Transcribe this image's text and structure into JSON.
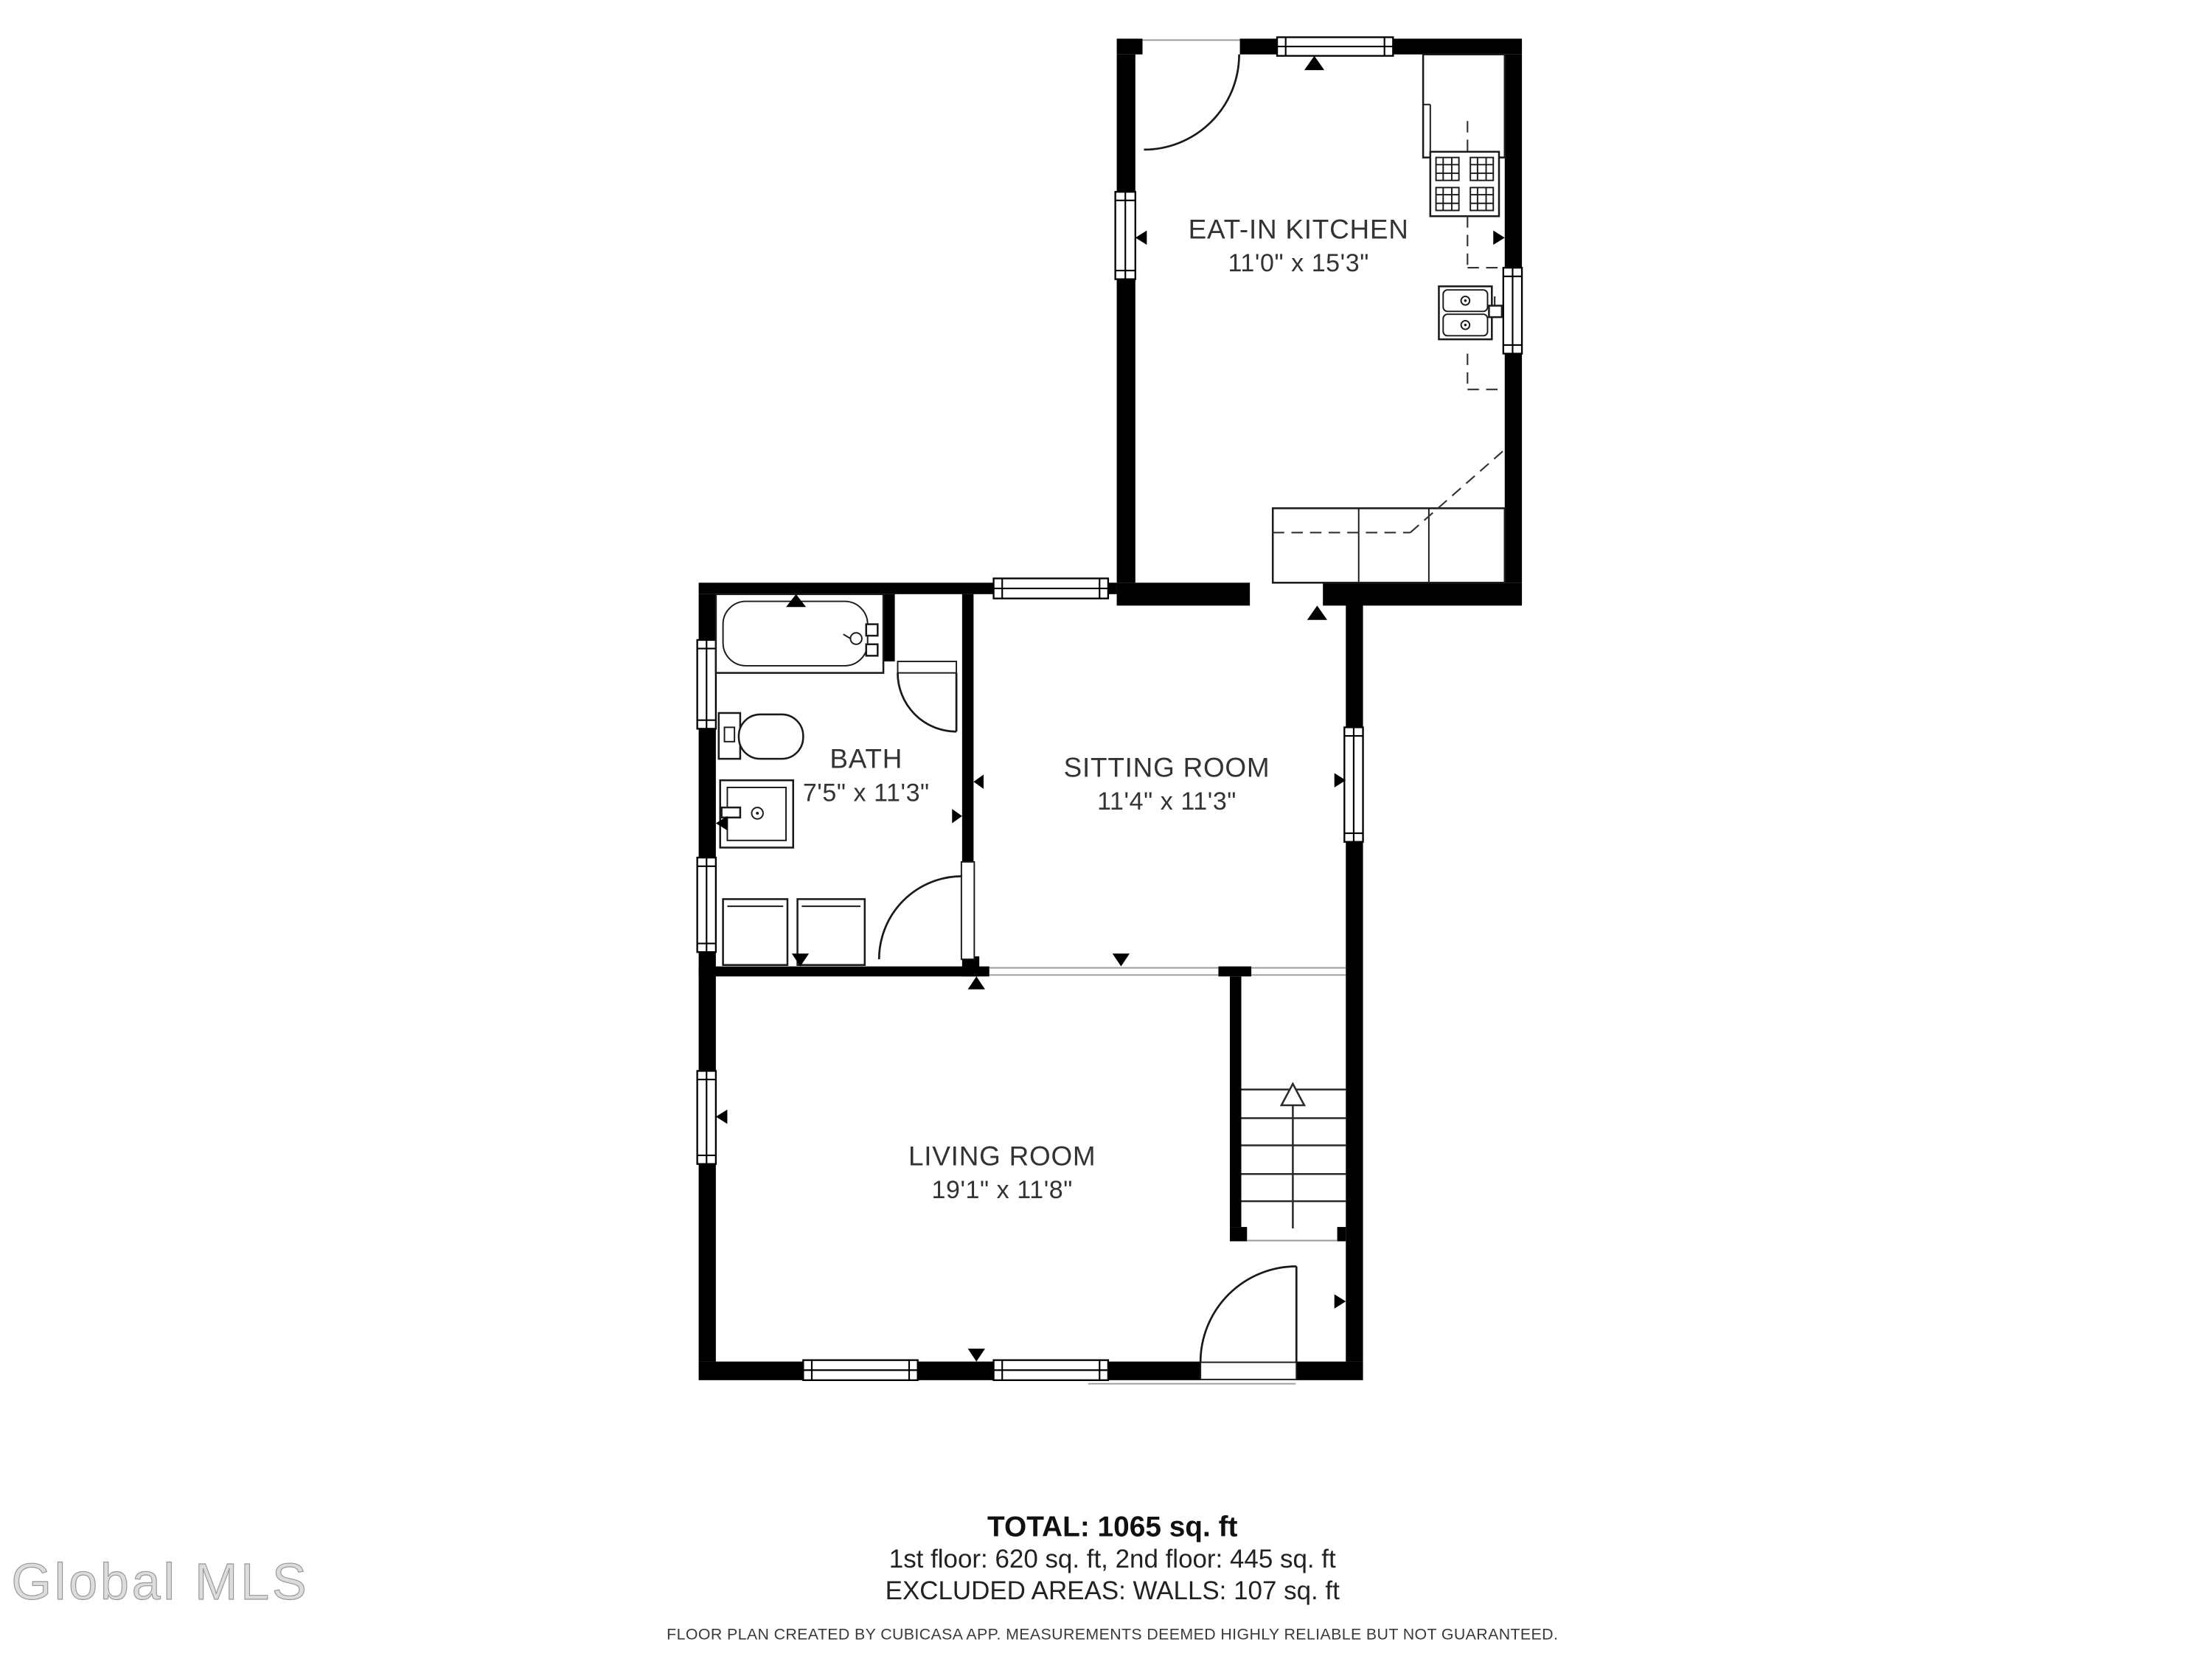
{
  "title": "Floor plan",
  "colors": {
    "wall": "#000000",
    "line": "#1a1a1a",
    "background": "#ffffff",
    "watermark_gray": "#dcdcdc"
  },
  "rooms": [
    {
      "name": "EAT-IN KITCHEN",
      "dims": "11'0\" x 15'3\""
    },
    {
      "name": "BATH",
      "dims": "7'5\" x 11'3\""
    },
    {
      "name": "SITTING ROOM",
      "dims": "11'4\" x 11'3\""
    },
    {
      "name": "LIVING ROOM",
      "dims": "19'1\" x 11'8\""
    }
  ],
  "summary": {
    "total": "TOTAL: 1065 sq. ft",
    "floors": "1st floor: 620 sq. ft, 2nd floor: 445 sq. ft",
    "excluded": "EXCLUDED AREAS: WALLS: 107 sq. ft"
  },
  "disclaimer": "FLOOR PLAN CREATED BY CUBICASA APP. MEASUREMENTS DEEMED HIGHLY RELIABLE BUT NOT GUARANTEED.",
  "watermark": "Global MLS",
  "icons": [
    "bathtub-icon",
    "toilet-icon",
    "sink-icon",
    "washer-icon",
    "dryer-icon",
    "stove-icon",
    "kitchen-sink-icon",
    "fridge-counter-icon",
    "stairs-up-arrow-icon",
    "door-swing-icon",
    "window-icon",
    "opening-marker-icon"
  ]
}
